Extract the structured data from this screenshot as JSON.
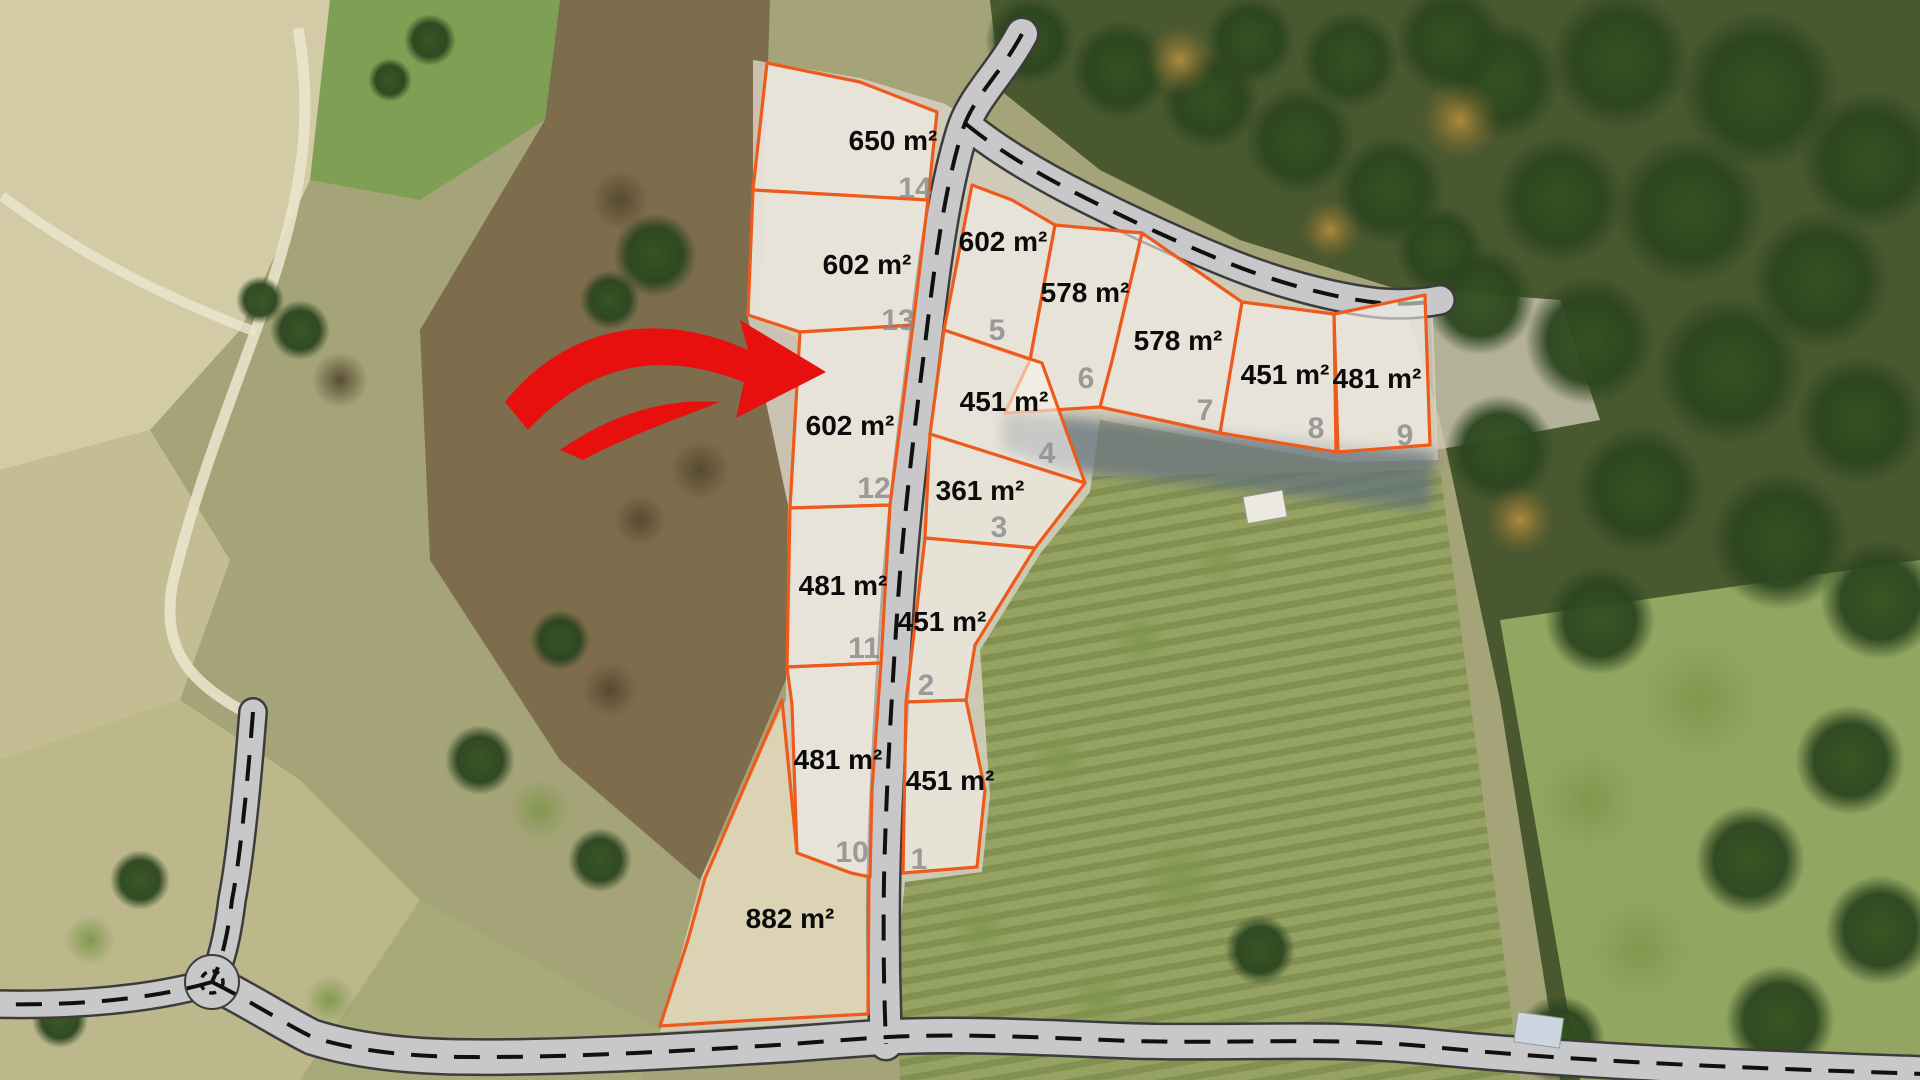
{
  "map": {
    "description": "aerial-parcel-plan",
    "overlay": {
      "parcel_stroke": "#ee5a1b",
      "parcel_fill": "rgba(247,243,236,0.60)",
      "label_color": "#0b0b0b",
      "number_color": "#8b8b8b",
      "arrow_color": "#e8100f"
    },
    "parcels": [
      {
        "number": "14",
        "area": "650 m²",
        "points": "767,63 860,82 937,112 928,200 753,190",
        "label_at": [
          893,
          150
        ],
        "number_at": [
          915,
          198
        ]
      },
      {
        "number": "13",
        "area": "602 m²",
        "points": "753,190 928,200 913,325 800,332 748,315",
        "label_at": [
          867,
          274
        ],
        "number_at": [
          898,
          330
        ]
      },
      {
        "number": "12",
        "area": "602 m²",
        "points": "800,332 913,325 890,505 790,508",
        "label_at": [
          850,
          435
        ],
        "number_at": [
          874,
          498
        ]
      },
      {
        "number": "11",
        "area": "481 m²",
        "points": "790,508 890,505 881,663 787,667",
        "label_at": [
          843,
          595
        ],
        "number_at": [
          864,
          658
        ]
      },
      {
        "number": "10",
        "area": "481 m²",
        "points": "787,667 881,663 872,790 870,877 851,873 797,853 792,705",
        "label_at": [
          838,
          769
        ],
        "number_at": [
          852,
          862
        ]
      },
      {
        "number": "",
        "area": "882 m²",
        "points": "782,700 797,853 851,873 869,877 868,1014 757,1020 660,1026 688,940 705,878",
        "label_at": [
          790,
          928
        ],
        "number_at": null,
        "tint": "rgba(233,224,172,0.42)"
      },
      {
        "number": "5",
        "area": "602 m²",
        "points": "972,185 1012,200 1055,225 1030,360 944,330",
        "label_at": [
          1003,
          251
        ],
        "number_at": [
          997,
          340
        ]
      },
      {
        "number": "6",
        "area": "578 m²",
        "points": "1055,225 1142,233 1113,357 1100,407 1005,413 1030,360",
        "label_at": [
          1085,
          302
        ],
        "number_at": [
          1086,
          388
        ]
      },
      {
        "number": "7",
        "area": "578 m²",
        "points": "1142,233 1190,266 1242,302 1220,433 1100,407 1113,357",
        "label_at": [
          1178,
          350
        ],
        "number_at": [
          1205,
          420
        ]
      },
      {
        "number": "8",
        "area": "451 m²",
        "points": "1242,302 1334,314 1336,452 1220,433",
        "label_at": [
          1285,
          384
        ],
        "number_at": [
          1316,
          438
        ]
      },
      {
        "number": "9",
        "area": "481 m²",
        "points": "1334,314 1425,295 1430,445 1338,452",
        "label_at": [
          1377,
          388
        ],
        "number_at": [
          1405,
          445
        ]
      },
      {
        "number": "4",
        "area": "451 m²",
        "points": "944,330 1042,363 1085,483 930,434",
        "label_at": [
          1004,
          411
        ],
        "number_at": [
          1047,
          463
        ]
      },
      {
        "number": "3",
        "area": "361 m²",
        "points": "930,434 1085,483 1035,548 925,538",
        "label_at": [
          980,
          500
        ],
        "number_at": [
          999,
          537
        ]
      },
      {
        "number": "2",
        "area": "451 m²",
        "points": "925,538 1035,548 975,645 966,700 906,702",
        "label_at": [
          942,
          631
        ],
        "number_at": [
          926,
          695
        ]
      },
      {
        "number": "1",
        "area": "451 m²",
        "points": "906,702 966,700 985,790 977,867 903,873",
        "label_at": [
          950,
          790
        ],
        "number_at": [
          919,
          869
        ]
      }
    ],
    "roads": [
      {
        "id": "main-road",
        "path": "M1022,34 C1000,75 972,98 962,132 C948,178 938,236 928,320 C917,410 905,500 898,600 C892,690 886,790 884,880 C883,945 884,995 886,1044",
        "w": 30
      },
      {
        "id": "east-branch-road",
        "path": "M966,124 C995,148 1032,170 1066,188 C1112,212 1172,240 1226,262 C1272,281 1332,298 1380,303 C1406,305 1424,303 1440,300",
        "w": 27
      },
      {
        "id": "bottom-road",
        "path": "M212,982 C252,1002 282,1022 312,1037 C362,1053 422,1057 472,1057 C562,1058 702,1050 792,1044 C842,1040 872,1038 888,1037 C962,1033 1052,1038 1132,1041 C1252,1044 1332,1036 1442,1048 C1602,1063 1752,1068 1925,1074",
        "w": 33
      },
      {
        "id": "left-road",
        "path": "M253,712 C247,790 240,858 232,900 C227,940 221,962 212,982",
        "w": 25
      },
      {
        "id": "left-exit-road",
        "path": "M212,982 C150,1000 70,1006 -6,1004",
        "w": 25
      }
    ],
    "junction": {
      "at": [
        212,
        982
      ],
      "r": 27
    },
    "arrow": {
      "body": "M505,402 C560,332 650,306 748,350 L740,320 L826,372 L736,418 L744,382 C660,350 592,362 528,430 Z",
      "swoosh": "M560,450 C615,412 668,398 720,402 C682,417 625,437 583,460 Z"
    },
    "buildings": [
      {
        "x": 1243,
        "y": 497,
        "w": 40,
        "h": 27,
        "rot": -10,
        "fill": "#ebe9e2"
      },
      {
        "x": 1518,
        "y": 1012,
        "w": 46,
        "h": 30,
        "rot": 8,
        "fill": "#ccd6e1"
      }
    ]
  }
}
